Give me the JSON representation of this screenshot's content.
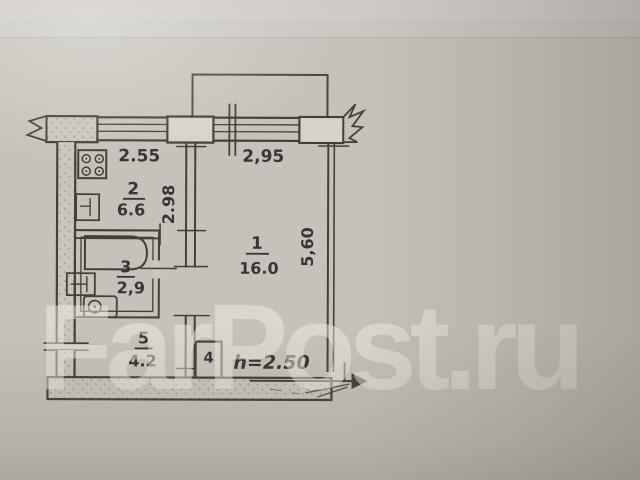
{
  "watermark": {
    "text": "FarPost.ru"
  },
  "colors": {
    "paper": "#c6c2bb",
    "ink": "#453f39",
    "pier_fill": "#d7d3cb",
    "watermark_fill": "rgba(240,235,225,0.50)"
  },
  "plan": {
    "ceiling_height": "h=2.50",
    "dimensions": {
      "kitchen_width": "2.55",
      "room_width": "2,95",
      "kitchen_depth": "2.98",
      "room_depth": "5,60"
    },
    "rooms": [
      {
        "number": "1",
        "area": "16.0",
        "name": "living-room"
      },
      {
        "number": "2",
        "area": "6.6",
        "name": "kitchen"
      },
      {
        "number": "3",
        "area": "2,9",
        "name": "bathroom"
      },
      {
        "number": "4",
        "area": "",
        "name": "closet"
      },
      {
        "number": "5",
        "area": "4.2",
        "name": "hallway"
      }
    ]
  }
}
